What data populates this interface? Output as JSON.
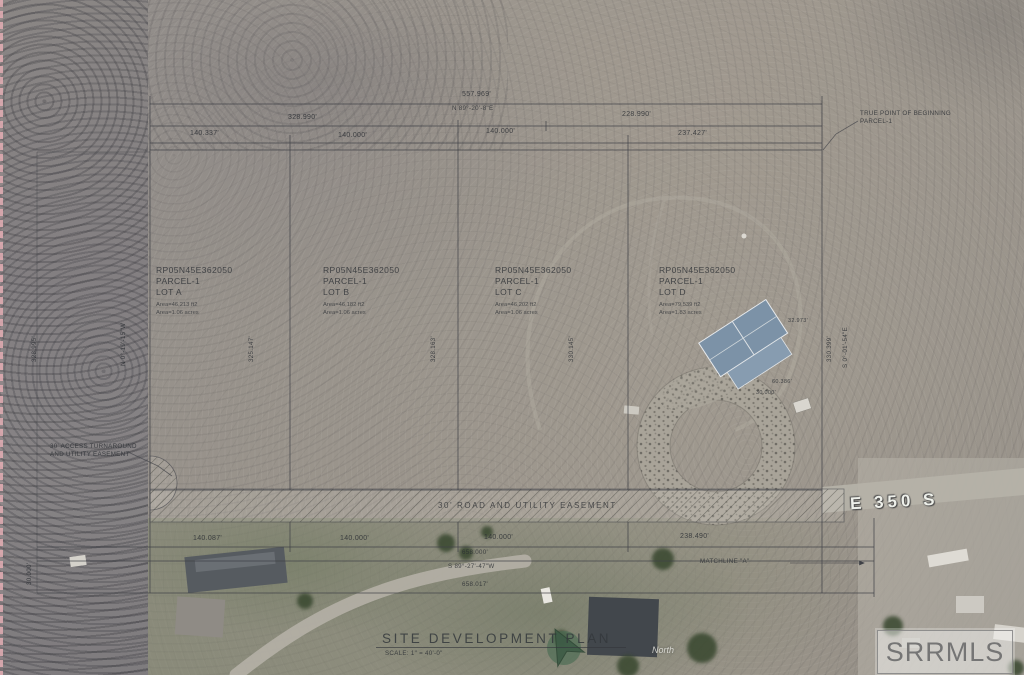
{
  "watermark": "SRRMLS",
  "title_block": {
    "title": "SITE DEVELOPMENT PLAN",
    "scale": "SCALE: 1\" = 40'-0\"",
    "north_label": "North"
  },
  "road": {
    "name": "E 350 S"
  },
  "notes": {
    "true_point_line1": "TRUE POINT OF BEGINNING",
    "true_point_line2": "PARCEL-1",
    "turnaround_line1": "30' ACCESS TURNAROUND",
    "turnaround_line2": "AND UTILITY EASEMENT",
    "road_easement": "30' ROAD AND UTILITY EASEMENT",
    "matchline": "MATCHLINE \"A\""
  },
  "lots": [
    {
      "apn": "RP05N45E362050",
      "parcel": "PARCEL-1",
      "name": "LOT A",
      "area_sqft": "Area=46,213 ft2",
      "area_acres": "Area=1.06 acres"
    },
    {
      "apn": "RP05N45E362050",
      "parcel": "PARCEL-1",
      "name": "LOT B",
      "area_sqft": "Area=46,182 ft2",
      "area_acres": "Area=1.06 acres"
    },
    {
      "apn": "RP05N45E362050",
      "parcel": "PARCEL-1",
      "name": "LOT C",
      "area_sqft": "Area=46,202 ft2",
      "area_acres": "Area=1.06 acres"
    },
    {
      "apn": "RP05N45E362050",
      "parcel": "PARCEL-1",
      "name": "LOT D",
      "area_sqft": "Area=79,539 ft2",
      "area_acres": "Area=1.83 acres"
    }
  ],
  "dims": {
    "top_total": "557.969'",
    "top_bearing": "N 89°-20'-8\"E",
    "top_left_half": "328.990'",
    "top_right_half": "228.990'",
    "top_lot_a": "140.337'",
    "top_lot_b": "140.000'",
    "top_lot_c": "140.000'",
    "top_lot_d": "237.427'",
    "bot_lot_a": "140.087'",
    "bot_lot_b": "140.000'",
    "bot_lot_c": "140.000'",
    "bot_lot_d": "238.490'",
    "bot_total_1": "658.000'",
    "bot_bearing": "S 89°-27'-47\"W",
    "bot_total_2": "658.017'",
    "side_left": "328.995'",
    "side_left_bearing": "N 0°-19'-15\"W",
    "side_ab": "325.147'",
    "side_bc": "328.163'",
    "side_cd": "330.145'",
    "side_right": "330.399'",
    "side_right_bearing": "S 0°-01'-54\"E",
    "easement_width": "30.000'",
    "bldg_1": "32.973'",
    "bldg_2": "60.386'",
    "bldg_3": "30.000'"
  },
  "colors": {
    "linework": "#3e4046",
    "section_line_pink": "#e4aeb4",
    "roof_blue": "#7c92a7",
    "road_label_white": "#eef0ea",
    "field_green": "#7c826a"
  }
}
